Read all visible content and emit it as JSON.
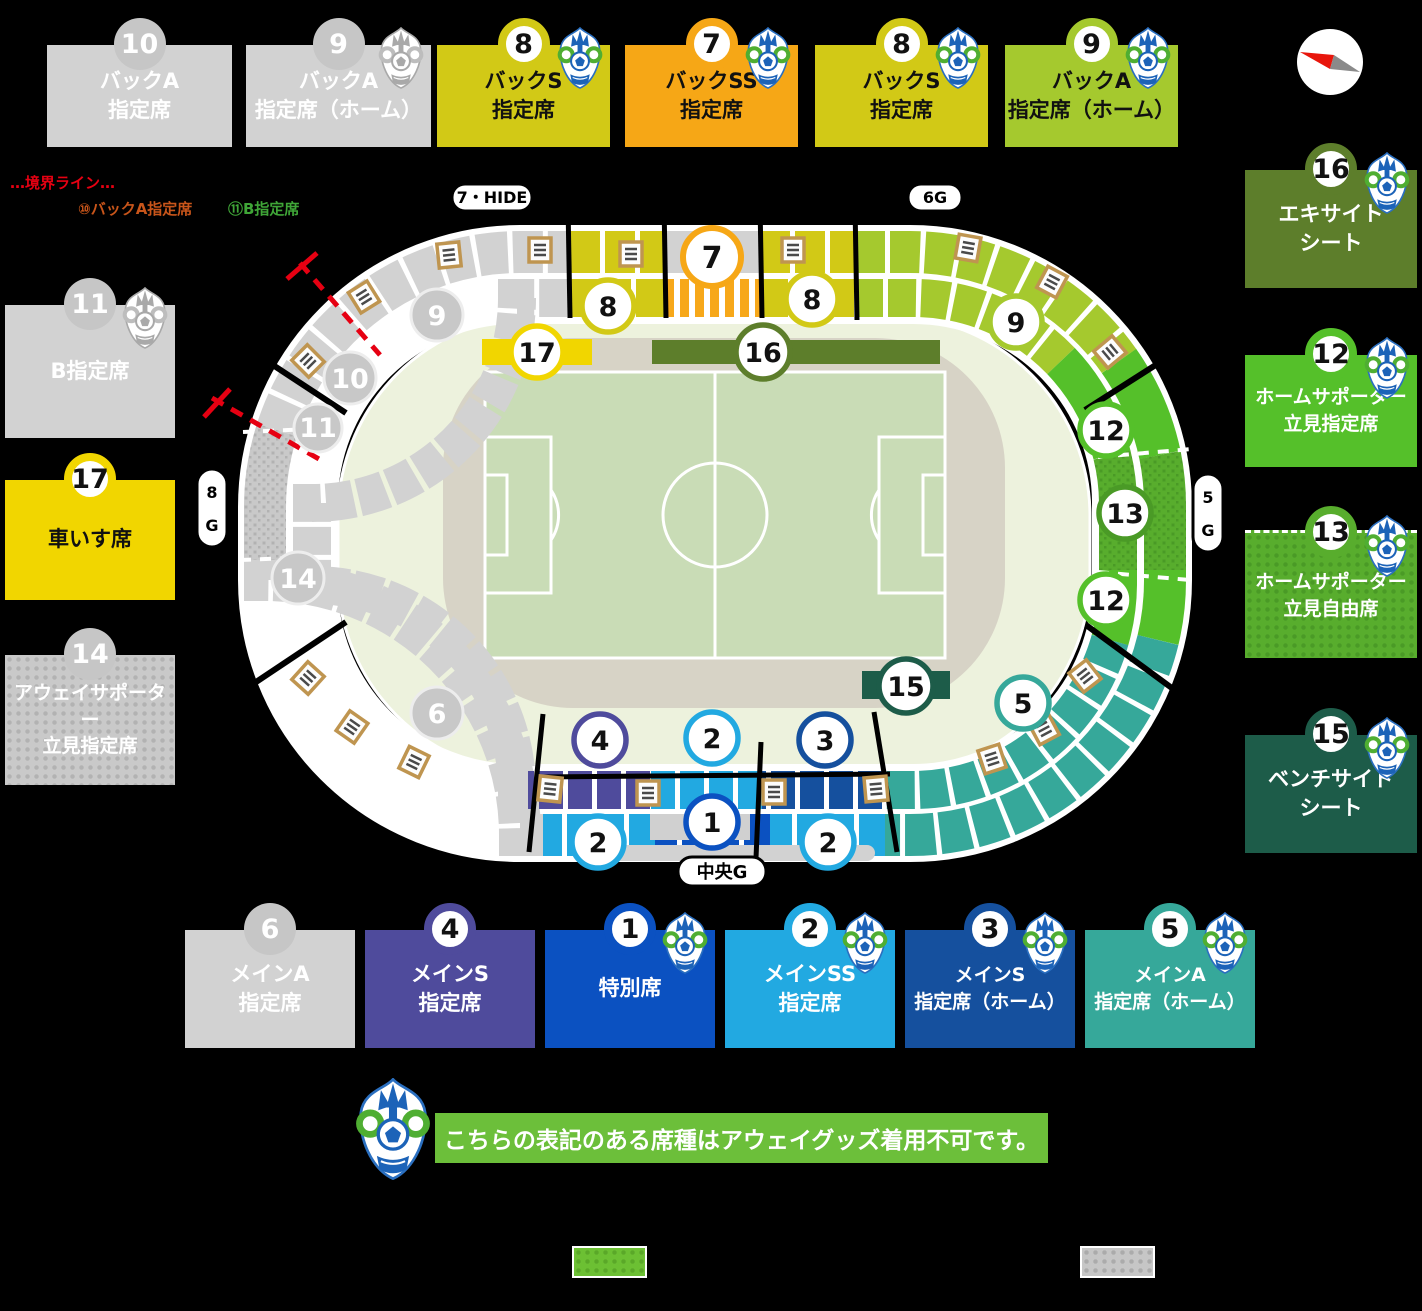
{
  "boundary_legend": {
    "title": "…境界ライン…",
    "item_back_a": "⑩バックA指定席",
    "item_b": "⑪B指定席"
  },
  "top_boxes": [
    {
      "num": "10",
      "label": "バックA\n指定席"
    },
    {
      "num": "9",
      "label": "バックA\n指定席（ホーム）"
    },
    {
      "num": "8",
      "label": "バックS\n指定席"
    },
    {
      "num": "7",
      "label": "バックSS\n指定席"
    },
    {
      "num": "8",
      "label": "バックS\n指定席"
    },
    {
      "num": "9",
      "label": "バックA\n指定席（ホーム）"
    }
  ],
  "left_boxes": [
    {
      "num": "11",
      "label": "B指定席"
    },
    {
      "num": "17",
      "label": "車いす席"
    },
    {
      "num": "14",
      "label": "アウェイサポーター\n立見指定席"
    }
  ],
  "right_boxes": [
    {
      "num": "16",
      "label": "エキサイト\nシート"
    },
    {
      "num": "12",
      "label": "ホームサポーター\n立見指定席"
    },
    {
      "num": "13",
      "label": "ホームサポーター\n立見自由席"
    },
    {
      "num": "15",
      "label": "ベンチサイド\nシート"
    }
  ],
  "bottom_boxes": [
    {
      "num": "6",
      "label": "メインA\n指定席"
    },
    {
      "num": "4",
      "label": "メインS\n指定席"
    },
    {
      "num": "1",
      "label": "特別席"
    },
    {
      "num": "2",
      "label": "メインSS\n指定席"
    },
    {
      "num": "3",
      "label": "メインS\n指定席（ホーム）"
    },
    {
      "num": "5",
      "label": "メインA\n指定席（ホーム）"
    }
  ],
  "gate_labels": {
    "back_gate": "7・HIDE",
    "gate6": "6G",
    "gate8": {
      "l1": "8",
      "l2": "G"
    },
    "gate5": {
      "l1": "5",
      "l2": "G"
    },
    "center_gate": "中央G"
  },
  "stadium_badges": {
    "n7": "7",
    "n8_left": "8",
    "n8_right": "8",
    "n9_home": "9",
    "n9_away": "9",
    "n10": "10",
    "n11": "11",
    "n14": "14",
    "n6": "6",
    "n12_top": "12",
    "n13": "13",
    "n12_bottom": "12",
    "n5": "5",
    "n4": "4",
    "n2_inner": "2",
    "n3": "3",
    "n1": "1",
    "n2_left": "2",
    "n2_right": "2",
    "n17": "17",
    "n16": "16",
    "n15": "15"
  },
  "notice": "こちらの表記のある席種はアウェイグッズ着用不可です。",
  "colors": {
    "gray": "#d2d2d2",
    "back_s_yellow": "#d2c916",
    "back_ss_orange": "#f6a716",
    "back_a_home_green": "#a5c92e",
    "excite_olive": "#5d7e2b",
    "home_supporter_green": "#55c02a",
    "home_free_green_pattern": "#58ad2d",
    "bench_side_teal": "#1d5c49",
    "main_s_purple": "#4f4b9c",
    "tokubetsu_blue": "#0b51c1",
    "main_ss_lightblue": "#22a9e1",
    "main_s_home_blue": "#15509e",
    "main_a_home_teal": "#36a89a",
    "wheelchair_yellow": "#f1d600",
    "field_green": "#c9dcb6",
    "track_beige": "#d7d3c6",
    "concourse_green": "#edf2dd",
    "boundary_red": "#e60012",
    "banner_green": "#6cbf3a",
    "swatch_green": "#6cc033",
    "swatch_gray": "#c6c6c6"
  }
}
